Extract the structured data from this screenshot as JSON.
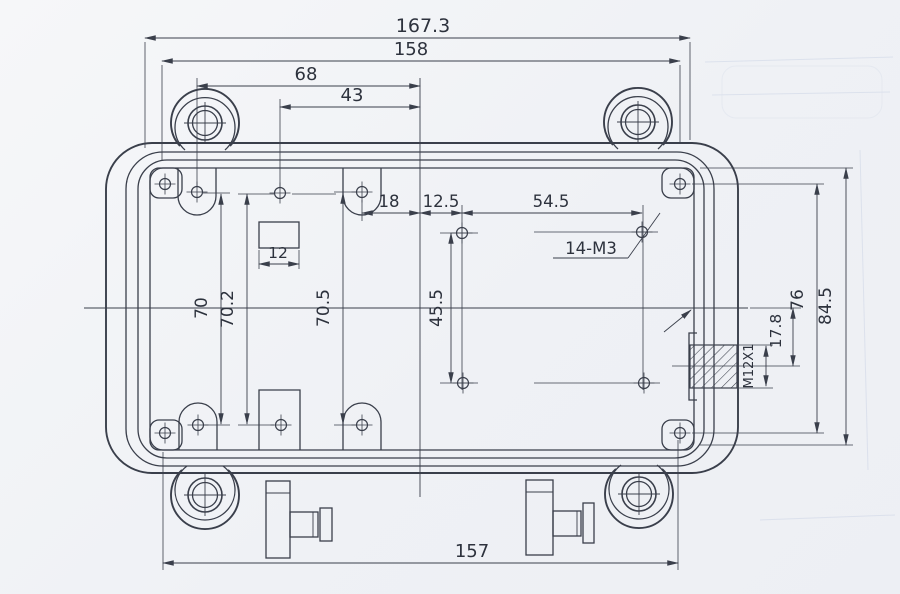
{
  "drawing": {
    "kind": "enclosure-dimension-drawing",
    "colors": {
      "line": "#3a3f4b",
      "text": "#2d323d",
      "background": "#eff1f5",
      "ghost": "#b9c6de"
    },
    "dims": {
      "overall_width": "167.3",
      "width_158": "158",
      "width_68": "68",
      "width_43": "43",
      "spacing_18": "18",
      "spacing_12_5": "12.5",
      "spacing_54_5": "54.5",
      "holes_note": "14-M3",
      "slot_12": "12",
      "height_70": "70",
      "height_70_2": "70.2",
      "height_70_5": "70.5",
      "height_45_5": "45.5",
      "width_157": "157",
      "offset_17_8": "17.8",
      "height_76": "76",
      "height_84_5": "84.5",
      "gland_thread": "M12X1"
    }
  }
}
